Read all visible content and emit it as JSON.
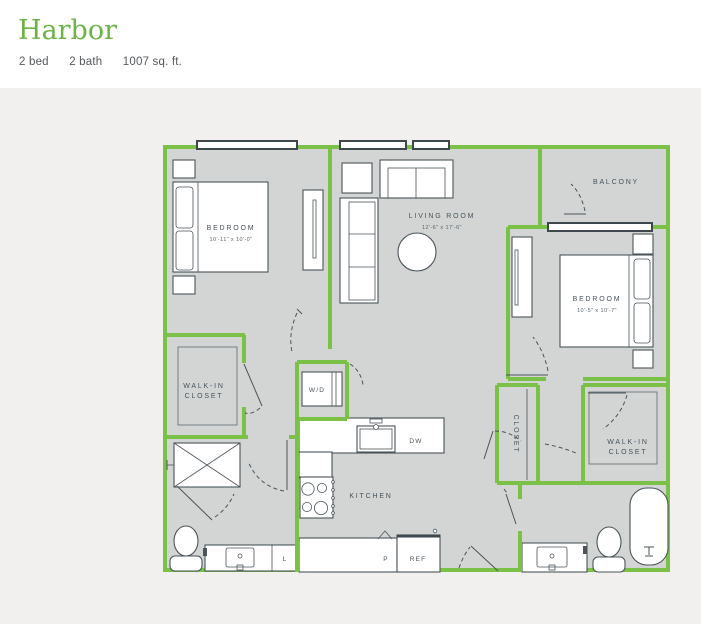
{
  "header": {
    "title": "Harbor",
    "specs": {
      "beds": "2 bed",
      "baths": "2 bath",
      "area": "1007 sq. ft."
    }
  },
  "floorplan": {
    "rooms": {
      "bedroom1": {
        "label": "BEDROOM",
        "dims": "10'-11\" x 10'-0\""
      },
      "living_room": {
        "label": "LIVING ROOM",
        "dims": "12'-6\" x 17'-6\""
      },
      "bedroom2": {
        "label": "BEDROOM",
        "dims": "10'-5\" x 10'-7\""
      },
      "balcony": {
        "label": "BALCONY"
      },
      "walk_in_closet_1": {
        "line1": "WALK-IN",
        "line2": "CLOSET"
      },
      "walk_in_closet_2": {
        "line1": "WALK-IN",
        "line2": "CLOSET"
      },
      "closet": {
        "label": "CLOSET"
      },
      "laundry": {
        "label": "W/D"
      },
      "kitchen": {
        "label": "KITCHEN"
      },
      "dishwasher": {
        "label": "DW"
      },
      "pantry": {
        "label": "P"
      },
      "refrigerator": {
        "label": "REF"
      },
      "linen": {
        "label": "L"
      }
    },
    "colors": {
      "accent": "#6cb244",
      "wall": "#7bc047",
      "floor": "#d2d5d4",
      "line": "#4a545a",
      "bg": "#f1f0ee"
    }
  }
}
